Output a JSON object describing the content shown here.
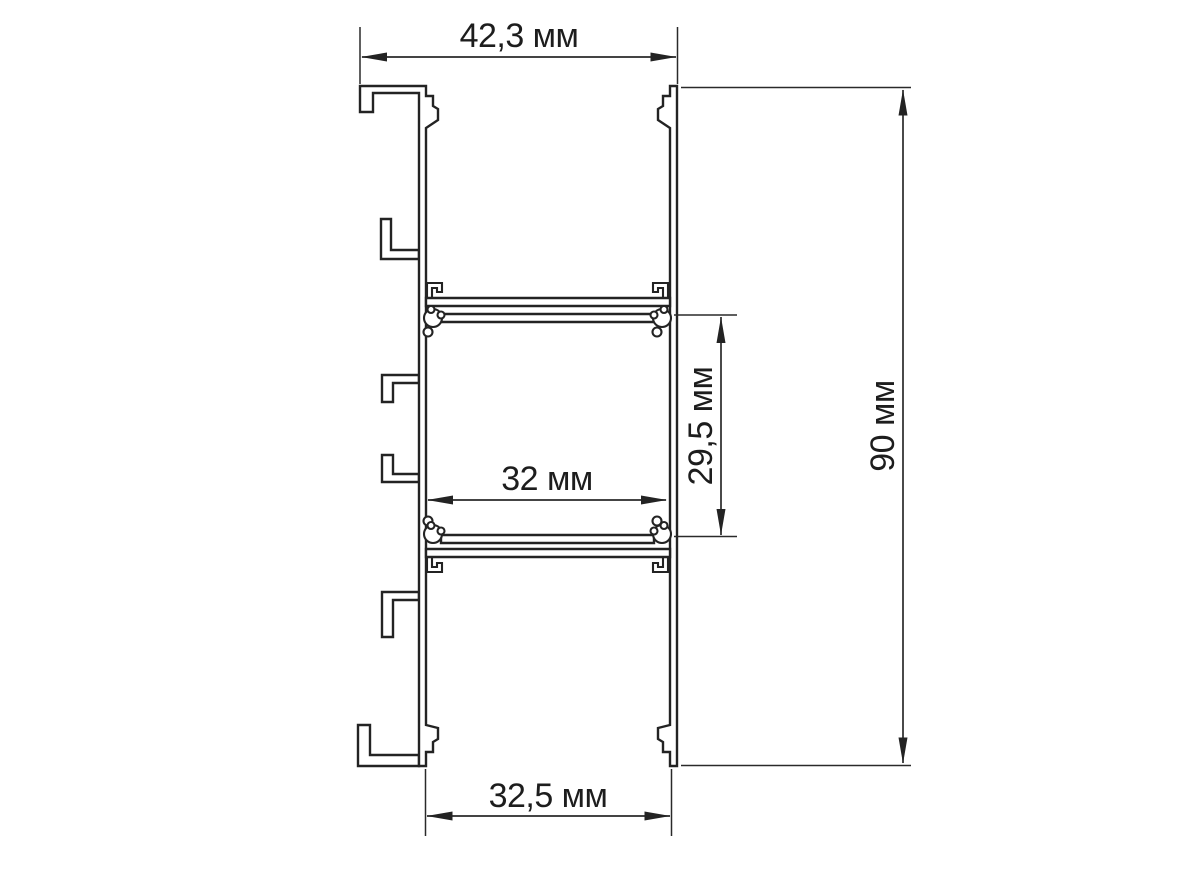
{
  "drawing": {
    "type": "profile-cross-section",
    "line_color": "#232323",
    "background": "#ffffff",
    "dimensions": {
      "top_width": "42,3 мм",
      "overall_height": "90 мм",
      "middle_cavity_height": "29,5 мм",
      "middle_cavity_width": "32 мм",
      "bottom_width": "32,5 мм"
    }
  }
}
